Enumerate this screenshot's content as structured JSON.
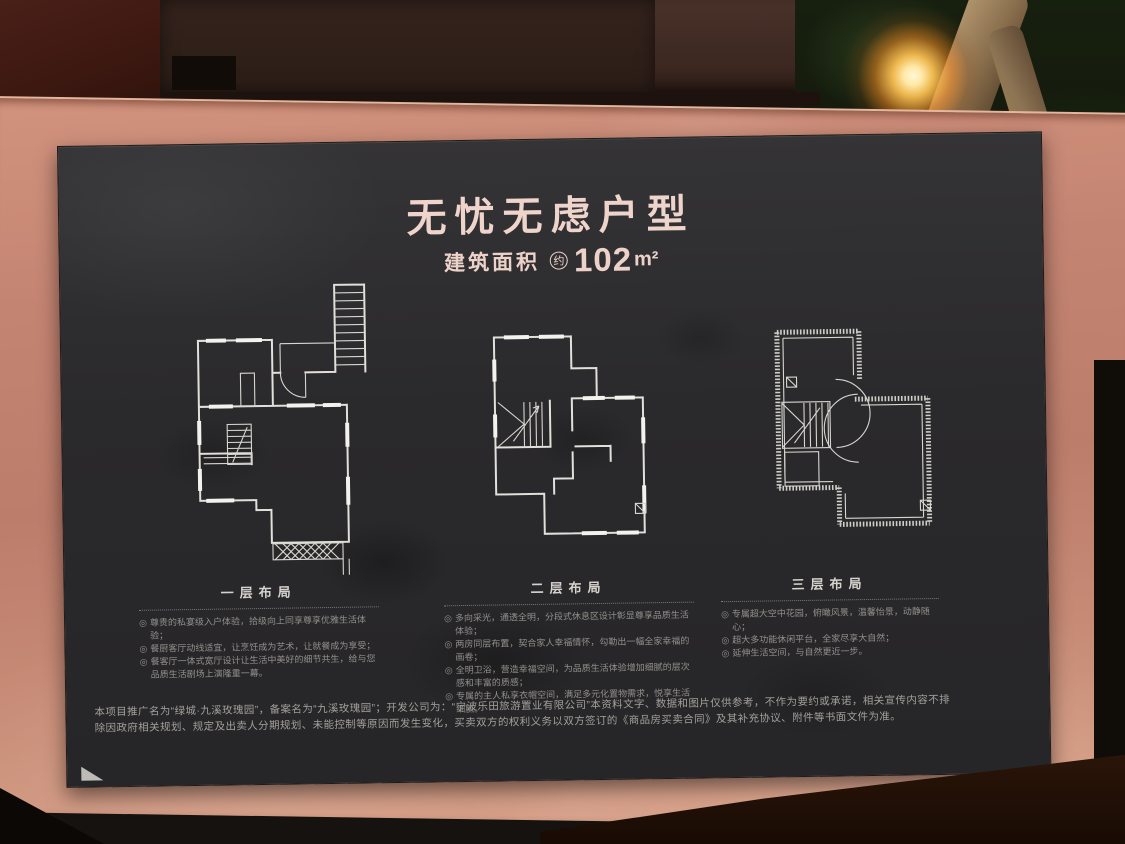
{
  "board": {
    "title": "无忧无虑户型",
    "area": {
      "label": "建筑面积",
      "approx": "约",
      "value": "102",
      "unit": "m²"
    },
    "bullet_marker": "◎",
    "floors": [
      {
        "label": "一层布局",
        "bullets": [
          "尊贵的私宴级入户体验，拾级向上同享尊享优雅生活体验；",
          "餐厨客厅动线适宜，让烹饪成为艺术，让就餐成为享受；",
          "餐客厅一体式宽厅设计让生活中美好的细节共生，给与您品质生活剧场上演隆重一幕。"
        ]
      },
      {
        "label": "二层布局",
        "bullets": [
          "多向采光，通透全明，分段式休息区设计彰显尊享品质生活体验；",
          "两房同层布置，契合家人幸福情怀，勾勒出一幅全家幸福的画卷；",
          "全明卫浴，营造幸福空间，为品质生活体验增加细腻的层次感和丰富的质感；",
          "专属的主人私享衣帽空间，满足多元化置物需求，悦享生活细腻。"
        ]
      },
      {
        "label": "三层布局",
        "bullets": [
          "专属超大空中花园，俯瞰风景，温馨怡景，动静随心；",
          "超大多功能休闲平台，全家尽享大自然；",
          "延伸生活空间，与自然更近一步。"
        ]
      }
    ],
    "disclaimer": "本项目推广名为“绿城·九溪玫瑰园”，备案名为“九溪玫瑰园”；开发公司为：“宁波乐田旅游置业有限公司”本资料文字、数据和图片仅供参考，不作为要约或承诺，相关宣传内容不排除因政府相关规划、规定及出卖人分期规划、未能控制等原因而发生变化，买卖双方的权利义务以双方签订的《商品房买卖合同》及其补充协议、附件等书面文件为准。"
  },
  "colors": {
    "frame_copper": "#c28472",
    "board_dark": "#2a292b",
    "title_pink": "#eed4cb",
    "plan_line": "#e2e0da",
    "text_muted": "#93908c"
  }
}
